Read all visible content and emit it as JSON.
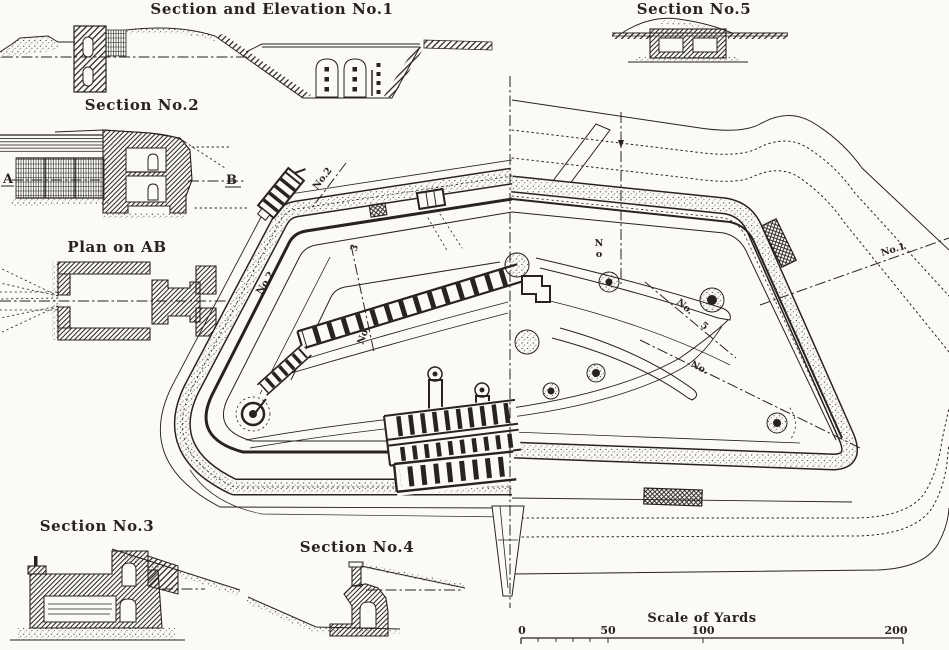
{
  "titles": {
    "section1": "Section and Elevation No.1",
    "section2": "Section No.2",
    "plan_ab": "Plan on AB",
    "section3": "Section No.3",
    "section4": "Section No.4",
    "section5": "Section No.5"
  },
  "markers": {
    "a": "A",
    "b": "B"
  },
  "scale": {
    "title": "Scale of Yards",
    "ticks": [
      "0",
      "50",
      "100",
      "200"
    ]
  },
  "plan": {
    "labels": [
      {
        "text": "No.2"
      },
      {
        "text": "No.2"
      },
      {
        "text": "3"
      },
      {
        "text": "No."
      },
      {
        "text": "No"
      },
      {
        "text": "No."
      },
      {
        "text": "5"
      },
      {
        "text": "No."
      },
      {
        "text": "No.1"
      }
    ]
  },
  "colors": {
    "ink": "#262320",
    "paper": "#fbfaf4"
  }
}
